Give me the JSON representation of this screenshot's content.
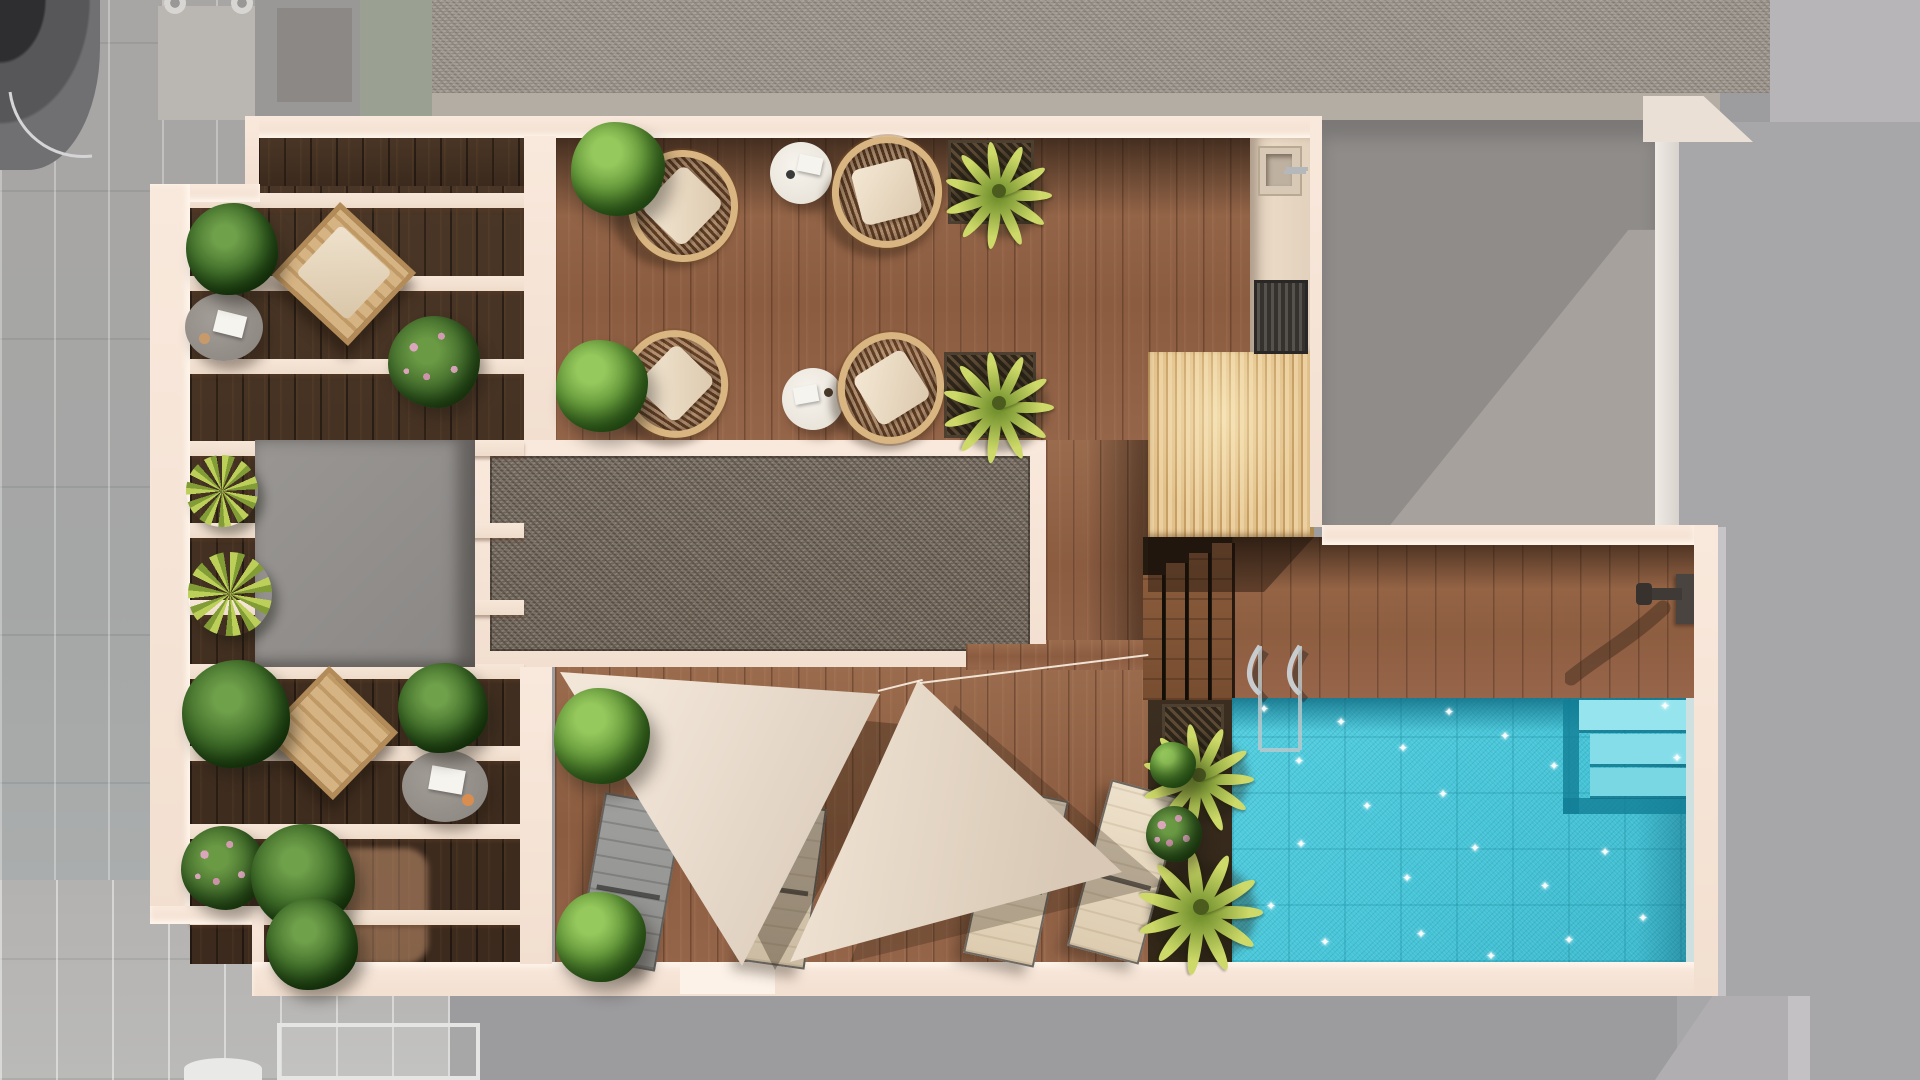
{
  "labels": {
    "scene": "rooftop terrace top-down plan render",
    "pool": "swimming pool",
    "pergola": "slatted pergola lounge",
    "kitchen": "outdoor kitchen",
    "sail_area": "shade sail sun deck",
    "gravel": "gravel skylight strip",
    "stairs": "deck stairs",
    "planter": "poolside planter"
  },
  "inventory": {
    "pools": 1,
    "shade_sails": 2,
    "sun_loungers": 4,
    "wicker_chairs": 4,
    "round_side_tables": 2,
    "gray_coffee_tables": 2,
    "hanging_chairs": 2,
    "pergola_beams": 10,
    "stair_treads": 4,
    "pool_steps": 3,
    "pool_ladders": 1,
    "outdoor_showers": 1,
    "sinks": 1,
    "grills": 1,
    "plants": 19
  },
  "palette": {
    "wall_cream": "#f6e5d8",
    "wall_highlight": "#fff4e8",
    "wood_medium": "#96664a",
    "wood_dark": "#46331f",
    "wood_pool_deck": "#9a6848",
    "pergola_slat_wood": "#ecd0a0",
    "gravel": "#7d7267",
    "roof_gravel": "#a29c94",
    "bulkhead_gray": "#918e8c",
    "pool_water": "#46c5d8",
    "pool_shadow": "#1a8aa2",
    "pool_step": "#8adfe9",
    "sail_fabric": "#ece0d2",
    "lounger_cream": "#e8dcc6",
    "lounger_gray": "#98989a",
    "plant_green": "#5a8f33",
    "plant_yellow": "#c3d45f",
    "flower_pink": "#d29cb0",
    "rattan": "#d9b582",
    "paving_gray": "#a9a7a5",
    "chrome": "#c9ccce"
  },
  "decor": {
    "pergola_beams_y": [
      193,
      276,
      359,
      441,
      523,
      600,
      664,
      746,
      824,
      910
    ],
    "stair_treads": [
      {
        "x": 1143,
        "w": 19,
        "y": 575
      },
      {
        "x": 1166,
        "w": 19,
        "y": 563
      },
      {
        "x": 1189,
        "w": 19,
        "y": 553
      },
      {
        "x": 1212,
        "w": 20,
        "y": 543
      }
    ],
    "pool_steps": [
      {
        "x": 1579,
        "y": 700,
        "w": 112,
        "h": 30,
        "c": "#96e4ed"
      },
      {
        "x": 1590,
        "y": 734,
        "w": 100,
        "h": 30,
        "c": "#85dde9"
      },
      {
        "x": 1590,
        "y": 768,
        "w": 98,
        "h": 28,
        "c": "#79d6e3"
      }
    ],
    "pool_sparkles": [
      [
        1259,
        703
      ],
      [
        1294,
        755
      ],
      [
        1336,
        716
      ],
      [
        1398,
        742
      ],
      [
        1444,
        706
      ],
      [
        1500,
        730
      ],
      [
        1549,
        760
      ],
      [
        1438,
        788
      ],
      [
        1362,
        800
      ],
      [
        1296,
        838
      ],
      [
        1266,
        900
      ],
      [
        1320,
        936
      ],
      [
        1402,
        872
      ],
      [
        1470,
        842
      ],
      [
        1540,
        880
      ],
      [
        1600,
        846
      ],
      [
        1638,
        912
      ],
      [
        1564,
        934
      ],
      [
        1486,
        950
      ],
      [
        1416,
        928
      ],
      [
        1672,
        752
      ],
      [
        1660,
        700
      ]
    ],
    "palm_leaf_angles": [
      0,
      32,
      65,
      98,
      130,
      162,
      196,
      228,
      262,
      296,
      330
    ],
    "plants": [
      {
        "t": "bush",
        "x": 571,
        "y": 122,
        "s": 94
      },
      {
        "t": "bush",
        "x": 556,
        "y": 340,
        "s": 92
      },
      {
        "t": "leafy",
        "x": 186,
        "y": 203,
        "s": 92
      },
      {
        "t": "flower",
        "x": 388,
        "y": 316,
        "s": 92
      },
      {
        "t": "spiky",
        "x": 186,
        "y": 455,
        "s": 72
      },
      {
        "t": "spiky",
        "x": 188,
        "y": 552,
        "s": 84
      },
      {
        "t": "leafy",
        "x": 182,
        "y": 660,
        "s": 108
      },
      {
        "t": "leafy",
        "x": 398,
        "y": 663,
        "s": 90
      },
      {
        "t": "flower",
        "x": 181,
        "y": 826,
        "s": 84
      },
      {
        "t": "leafy",
        "x": 251,
        "y": 824,
        "s": 104
      },
      {
        "t": "leafy",
        "x": 266,
        "y": 898,
        "s": 92
      },
      {
        "t": "bush",
        "x": 554,
        "y": 688,
        "s": 96
      },
      {
        "t": "bush",
        "x": 556,
        "y": 892,
        "s": 90
      },
      {
        "t": "palm",
        "x": 948,
        "y": 140,
        "s": 100
      },
      {
        "t": "palm",
        "x": 946,
        "y": 350,
        "s": 104
      },
      {
        "t": "palm",
        "x": 1146,
        "y": 722,
        "s": 104
      },
      {
        "t": "palm",
        "x": 1142,
        "y": 848,
        "s": 116
      },
      {
        "t": "flower",
        "x": 1146,
        "y": 806,
        "s": 56
      },
      {
        "t": "bush",
        "x": 1150,
        "y": 742,
        "s": 46
      }
    ]
  }
}
